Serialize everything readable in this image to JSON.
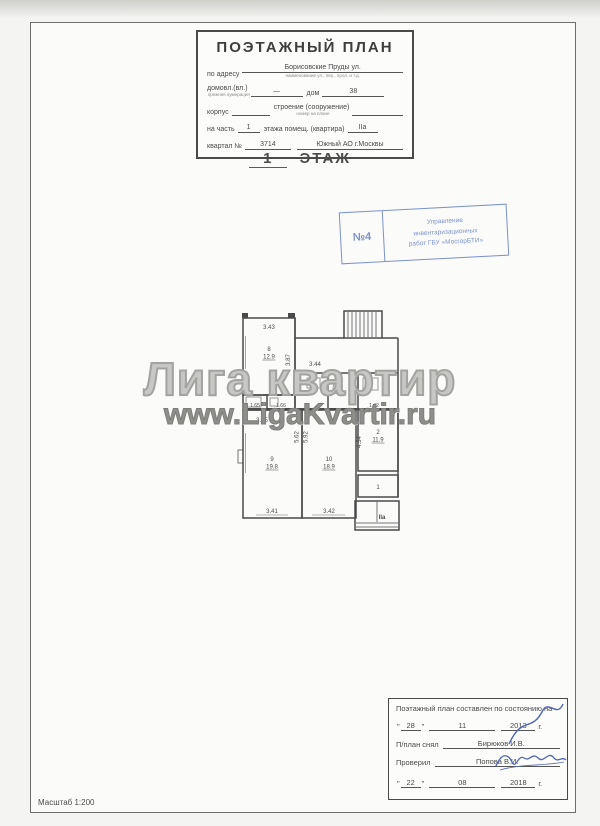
{
  "colors": {
    "stamp_blue": "#7d92cc",
    "premise_red": "#c2566b",
    "watermark_gray": "#8e8e8b",
    "ink": "#4a4a4a"
  },
  "header_form": {
    "title": "ПОЭТАЖНЫЙ ПЛАН",
    "address_label": "по адресу",
    "address_value": "Борисовские Пруды ул.",
    "address_caption": "наименование ул., пер., прол. и т.д.",
    "ownership_label": "домовл.(вл.)",
    "ownership_caption": "прежняя нумерация",
    "ownership_value": "—",
    "house_label": "дом",
    "house_value": "38",
    "building_label": "корпус",
    "structure_label": "строение (сооружение)",
    "structure_caption": "номер на плане",
    "part_label": "на часть",
    "part_value": "1",
    "part_mid_label": "этажа помещ. (квартира)",
    "part_premise_value": "IIа",
    "block_label": "квартал №",
    "block_value": "3714",
    "district_value": "Южный АО г.Москвы"
  },
  "floor_heading": {
    "number": "1",
    "word": "ЭТАЖ"
  },
  "stamp": {
    "number": "№4",
    "line1": "Управление",
    "line2": "инвентаризационных",
    "line3": "работ ГБУ «МосгорБТИ»"
  },
  "watermark": {
    "line1": "Лига квартир",
    "line2": "www.LigaKvartir.ru"
  },
  "plan": {
    "rooms": {
      "r8": {
        "num": "8",
        "area": "12.9"
      },
      "r9": {
        "num": "9",
        "area": "19.8"
      },
      "r10": {
        "num": "10",
        "area": "18.9"
      },
      "r2": {
        "num": "2",
        "area": "11.9"
      },
      "r1": {
        "num": "1"
      }
    },
    "dims": {
      "w8": "3.43",
      "h8": "3.87",
      "hall": "3.44",
      "wc": "1.65",
      "bath": "1.66",
      "mid": "3.65",
      "v9": "5.62",
      "v10": "5.92",
      "h2": "4.34",
      "w9": "3.41",
      "w10": "3.42",
      "porch": "1.42"
    },
    "premise_label": "IIа"
  },
  "footer_table": {
    "title": "Поэтажный план составлен по состоянию на",
    "date1": {
      "day": "28",
      "month": "11",
      "year": "2013",
      "suffix": "г."
    },
    "surveyed_label": "П/план снял",
    "surveyed_value": "Бирюков И.В.",
    "checked_label": "Проверил",
    "checked_value": "Попова В.И.",
    "date2": {
      "day": "22",
      "month": "08",
      "year": "2018",
      "suffix": "г."
    }
  },
  "scale_note": "Масштаб 1:200"
}
